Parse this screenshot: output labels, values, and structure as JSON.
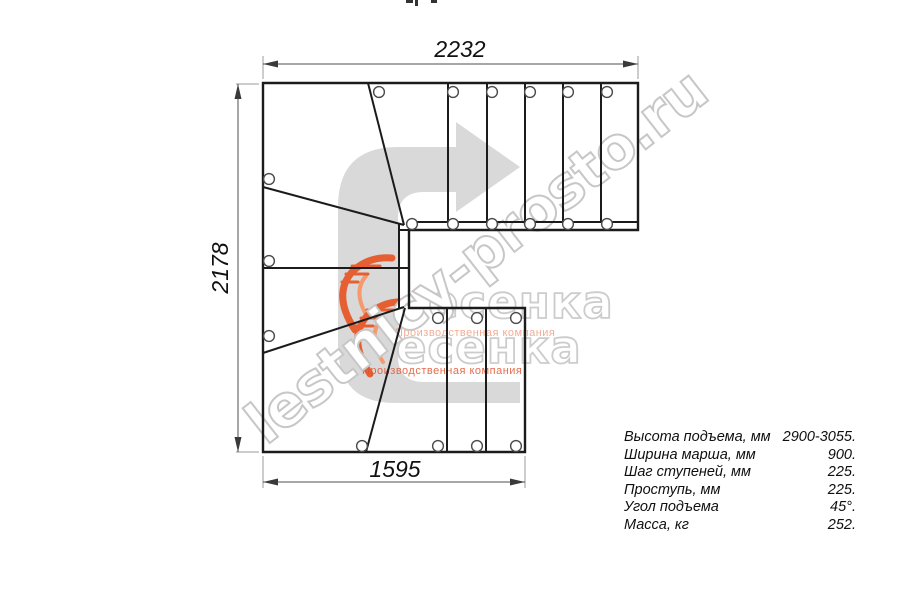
{
  "drawing": {
    "type": "staircase-plan-top-view",
    "description": "Plan of a modular staircase with a 180-degree turn on winder steps: 3 straight treads in lower flight, 5 winder treads in the turn, 6 straight treads in upper flight",
    "dimensions": {
      "top_mm": "2232",
      "left_mm": "2178",
      "bottom_mm": "1595"
    },
    "colors": {
      "line": "#1b1b1b",
      "dimension": "#4f4f4f",
      "extension": "#9b9b9b",
      "direction_arrow_fill": "#d9d9d9",
      "watermark_gray": "#c7c7c7",
      "logo_orange": "#e55f33",
      "tagline_light": "#e8774f",
      "tagline_strong": "#df5430"
    }
  },
  "specs": {
    "rows": [
      {
        "label": "Высота подъема, мм",
        "value": "2900-3055."
      },
      {
        "label": "Ширина марша, мм",
        "value": "900."
      },
      {
        "label": "Шаг ступеней, мм",
        "value": "225."
      },
      {
        "label": "Проступь, мм",
        "value": "225."
      },
      {
        "label": "Угол подъема",
        "value": "45°."
      },
      {
        "label": "Масса, кг",
        "value": "252."
      }
    ]
  },
  "watermark": {
    "site_text": "lestnicy-prosto.ru",
    "logo_text": "есенка",
    "tagline": "Производственная компания"
  }
}
